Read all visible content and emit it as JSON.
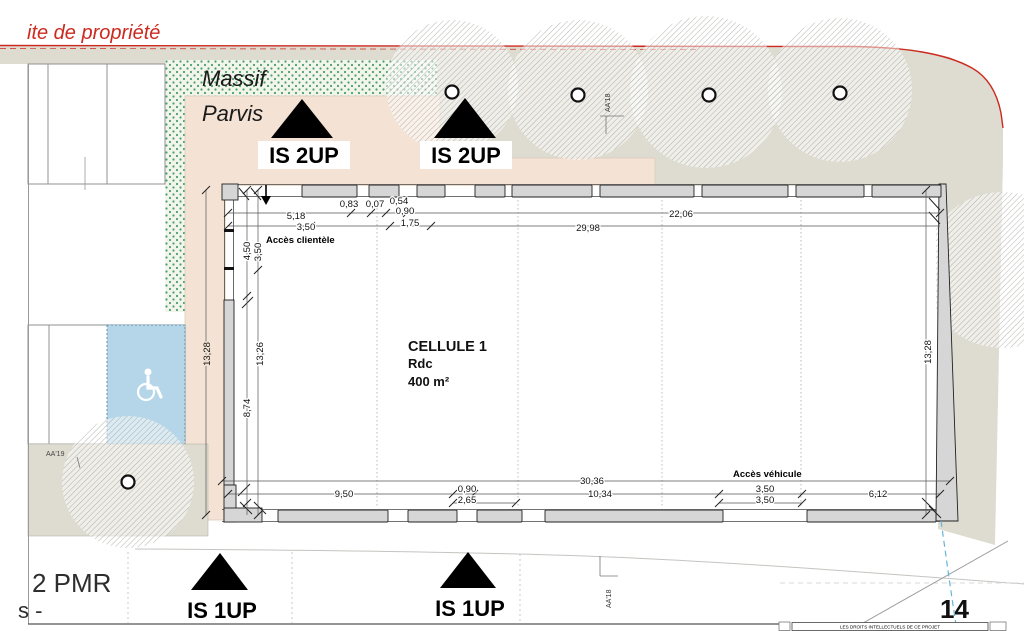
{
  "colors": {
    "ground": "#dedcd0",
    "parvis": "#f4e3d4",
    "massif_bg": "#f1f5ec",
    "massif_dot": "#4d9e68",
    "accessible_blue": "#b5d6e8",
    "property_red": "#cc2a20",
    "wall_fill": "#d6d6d6"
  },
  "site": {
    "property_line_label": "ite de propriété",
    "massif": "Massif",
    "parvis": "Parvis",
    "pmr": "2 PMR",
    "edge_text": "s -",
    "sheet_number": "14",
    "footer": "LES DROITS INTELLECTUELS DE CE PROJET",
    "section_top": "AA'18",
    "section_bottom": "AA'18",
    "section_left": "AA'19"
  },
  "building": {
    "name": "CELLULE 1",
    "level": "Rdc",
    "area": "400 m²",
    "access_client": "Accès clientèle",
    "access_vehicle": "Accès véhicule"
  },
  "exits": {
    "up2": "IS 2UP",
    "up1": "IS 1UP"
  },
  "dims": {
    "top": {
      "d5_18": "5,18",
      "d3_50": "3,50",
      "d0_83": "0,83",
      "d0_07": "0,07",
      "d0_54": "0,54",
      "d0_90": "0,90",
      "d1_75": "1,75",
      "d29_98": "29,98",
      "d22_06": "22,06"
    },
    "left": {
      "d4_50": "4,50",
      "d3_50": "3,50",
      "d13_28": "13,28",
      "d13_26": "13,26",
      "d8_74": "8,74"
    },
    "right": {
      "d13_28": "13,28"
    },
    "bottom": {
      "d30_36": "30,36",
      "d9_50": "9,50",
      "d0_90": "0,90",
      "d2_65": "2,65",
      "d10_34": "10,34",
      "d3_50a": "3,50",
      "d3_50b": "3,50",
      "d6_12": "6,12"
    }
  }
}
